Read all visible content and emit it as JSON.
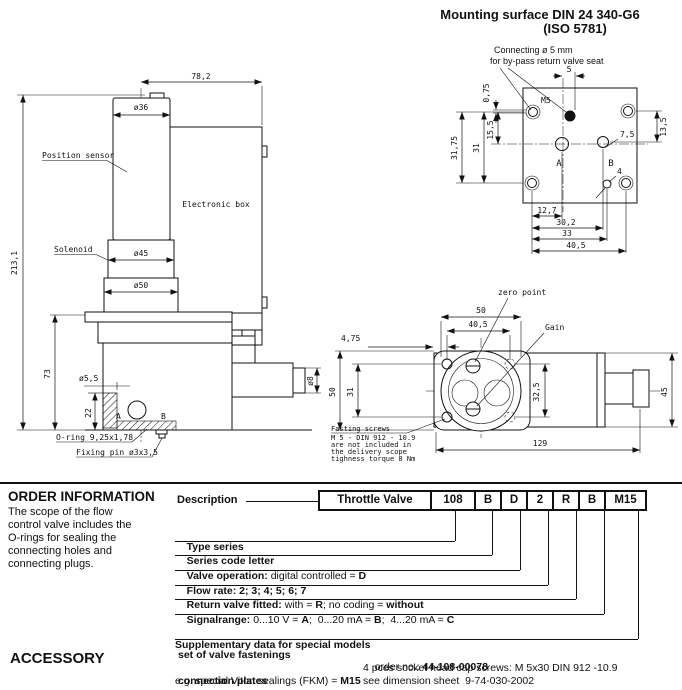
{
  "side_view": {
    "dim_width": "78,2",
    "dim_sensor_dia": "ø36",
    "label_position_sensor": "Position sensor",
    "label_electronic_box": "Electronic box",
    "label_solenoid": "Solenoid",
    "dim_solenoid_dia": "ø45",
    "dim_body_dia": "ø50",
    "dim_total_height": "213,1",
    "dim_body_height": "73",
    "dim_hole_dia": "ø5,5",
    "dim_hole_depth": "22",
    "dim_plug_len": "20",
    "dim_plug_len2": "(12)",
    "dim_plug_dia": "ø8",
    "label_o_ring": "O-ring 9,25x1,78",
    "label_fixing_pin": "Fixing pin ø3x3,5",
    "label_port_a": "A",
    "label_port_b": "B"
  },
  "mounting_surface": {
    "title_line1": "Mounting surface DIN 24 340-G6",
    "title_line2": "(ISO 5781)",
    "note_line1": "Connecting ø 5 mm",
    "note_line2": "for by-pass return valve seat",
    "label_m5": "M5",
    "label_port_a": "A",
    "label_port_b": "B",
    "dim_5": "5",
    "dim_075": "0,75",
    "dim_155": "15,5",
    "dim_31": "31",
    "dim_3175": "31,75",
    "dim_135": "13,5",
    "dim_75": "7,5",
    "dim_4": "4",
    "dim_127": "12,7",
    "dim_302": "30,2",
    "dim_33": "33",
    "dim_405": "40,5"
  },
  "top_view": {
    "label_zero_point": "zero point",
    "label_gain": "Gain",
    "dim_50_top": "50",
    "dim_405": "40,5",
    "dim_475": "4,75",
    "dim_50_left": "50",
    "dim_31": "31",
    "dim_325": "32,5",
    "dim_45": "45",
    "dim_129": "129",
    "note_line1": "Fasting screws",
    "note_line2": "M 5 - DIN 912 - 10.9",
    "note_line3": "are not included in",
    "note_line4": "the delivery scope",
    "note_line5": "tighness torque 8 Nm"
  },
  "order_information": {
    "heading": "ORDER INFORMATION",
    "paragraph_lines": [
      "The scope of the flow",
      "control valve includes the",
      "O-rings for sealing the",
      "connecting holes and",
      "connecting plugs."
    ],
    "description_label": "Description",
    "code_boxes": [
      "Throttle Valve",
      "108",
      "B",
      "D",
      "2",
      "R",
      "B",
      "M15"
    ],
    "rows": {
      "r1b1": "Type series",
      "r2b1": "Series code letter",
      "r3b1": "Valve operation:",
      "r3r1": " digital controlled = ",
      "r3b2": "D",
      "r4b1": "Flow rate: 2; 3; 4; 5; 6; 7",
      "r5b1": "Return valve fitted:",
      "r5r1": " with = ",
      "r5b2": "R",
      "r5r2": "; no coding = ",
      "r5b3": "without",
      "r6b1": "Signalrange:",
      "r6r1": " 0...10 V = ",
      "r6b2": "A",
      "r6r2": ";  0...20 mA = ",
      "r6b3": "B",
      "r6r3": ";  4...20 mA = ",
      "r6b4": "C",
      "r7b1": "Supplementary data for special models",
      "r7r1": "e.g. special Viton sealings (FKM) = ",
      "r7b2": "M15"
    }
  },
  "accessory": {
    "heading": "ACCESSORY",
    "item1_label": "set of valve fastenings",
    "item1_value_prefix": "order no.: ",
    "item1_order_no": "44-108-00078",
    "item1_line2": "4 pces socket head cap screws: M 5x30 DIN 912 -10.9",
    "item2_label": "connection plates",
    "item2_value": "see dimension sheet  9-74-030-2002"
  }
}
